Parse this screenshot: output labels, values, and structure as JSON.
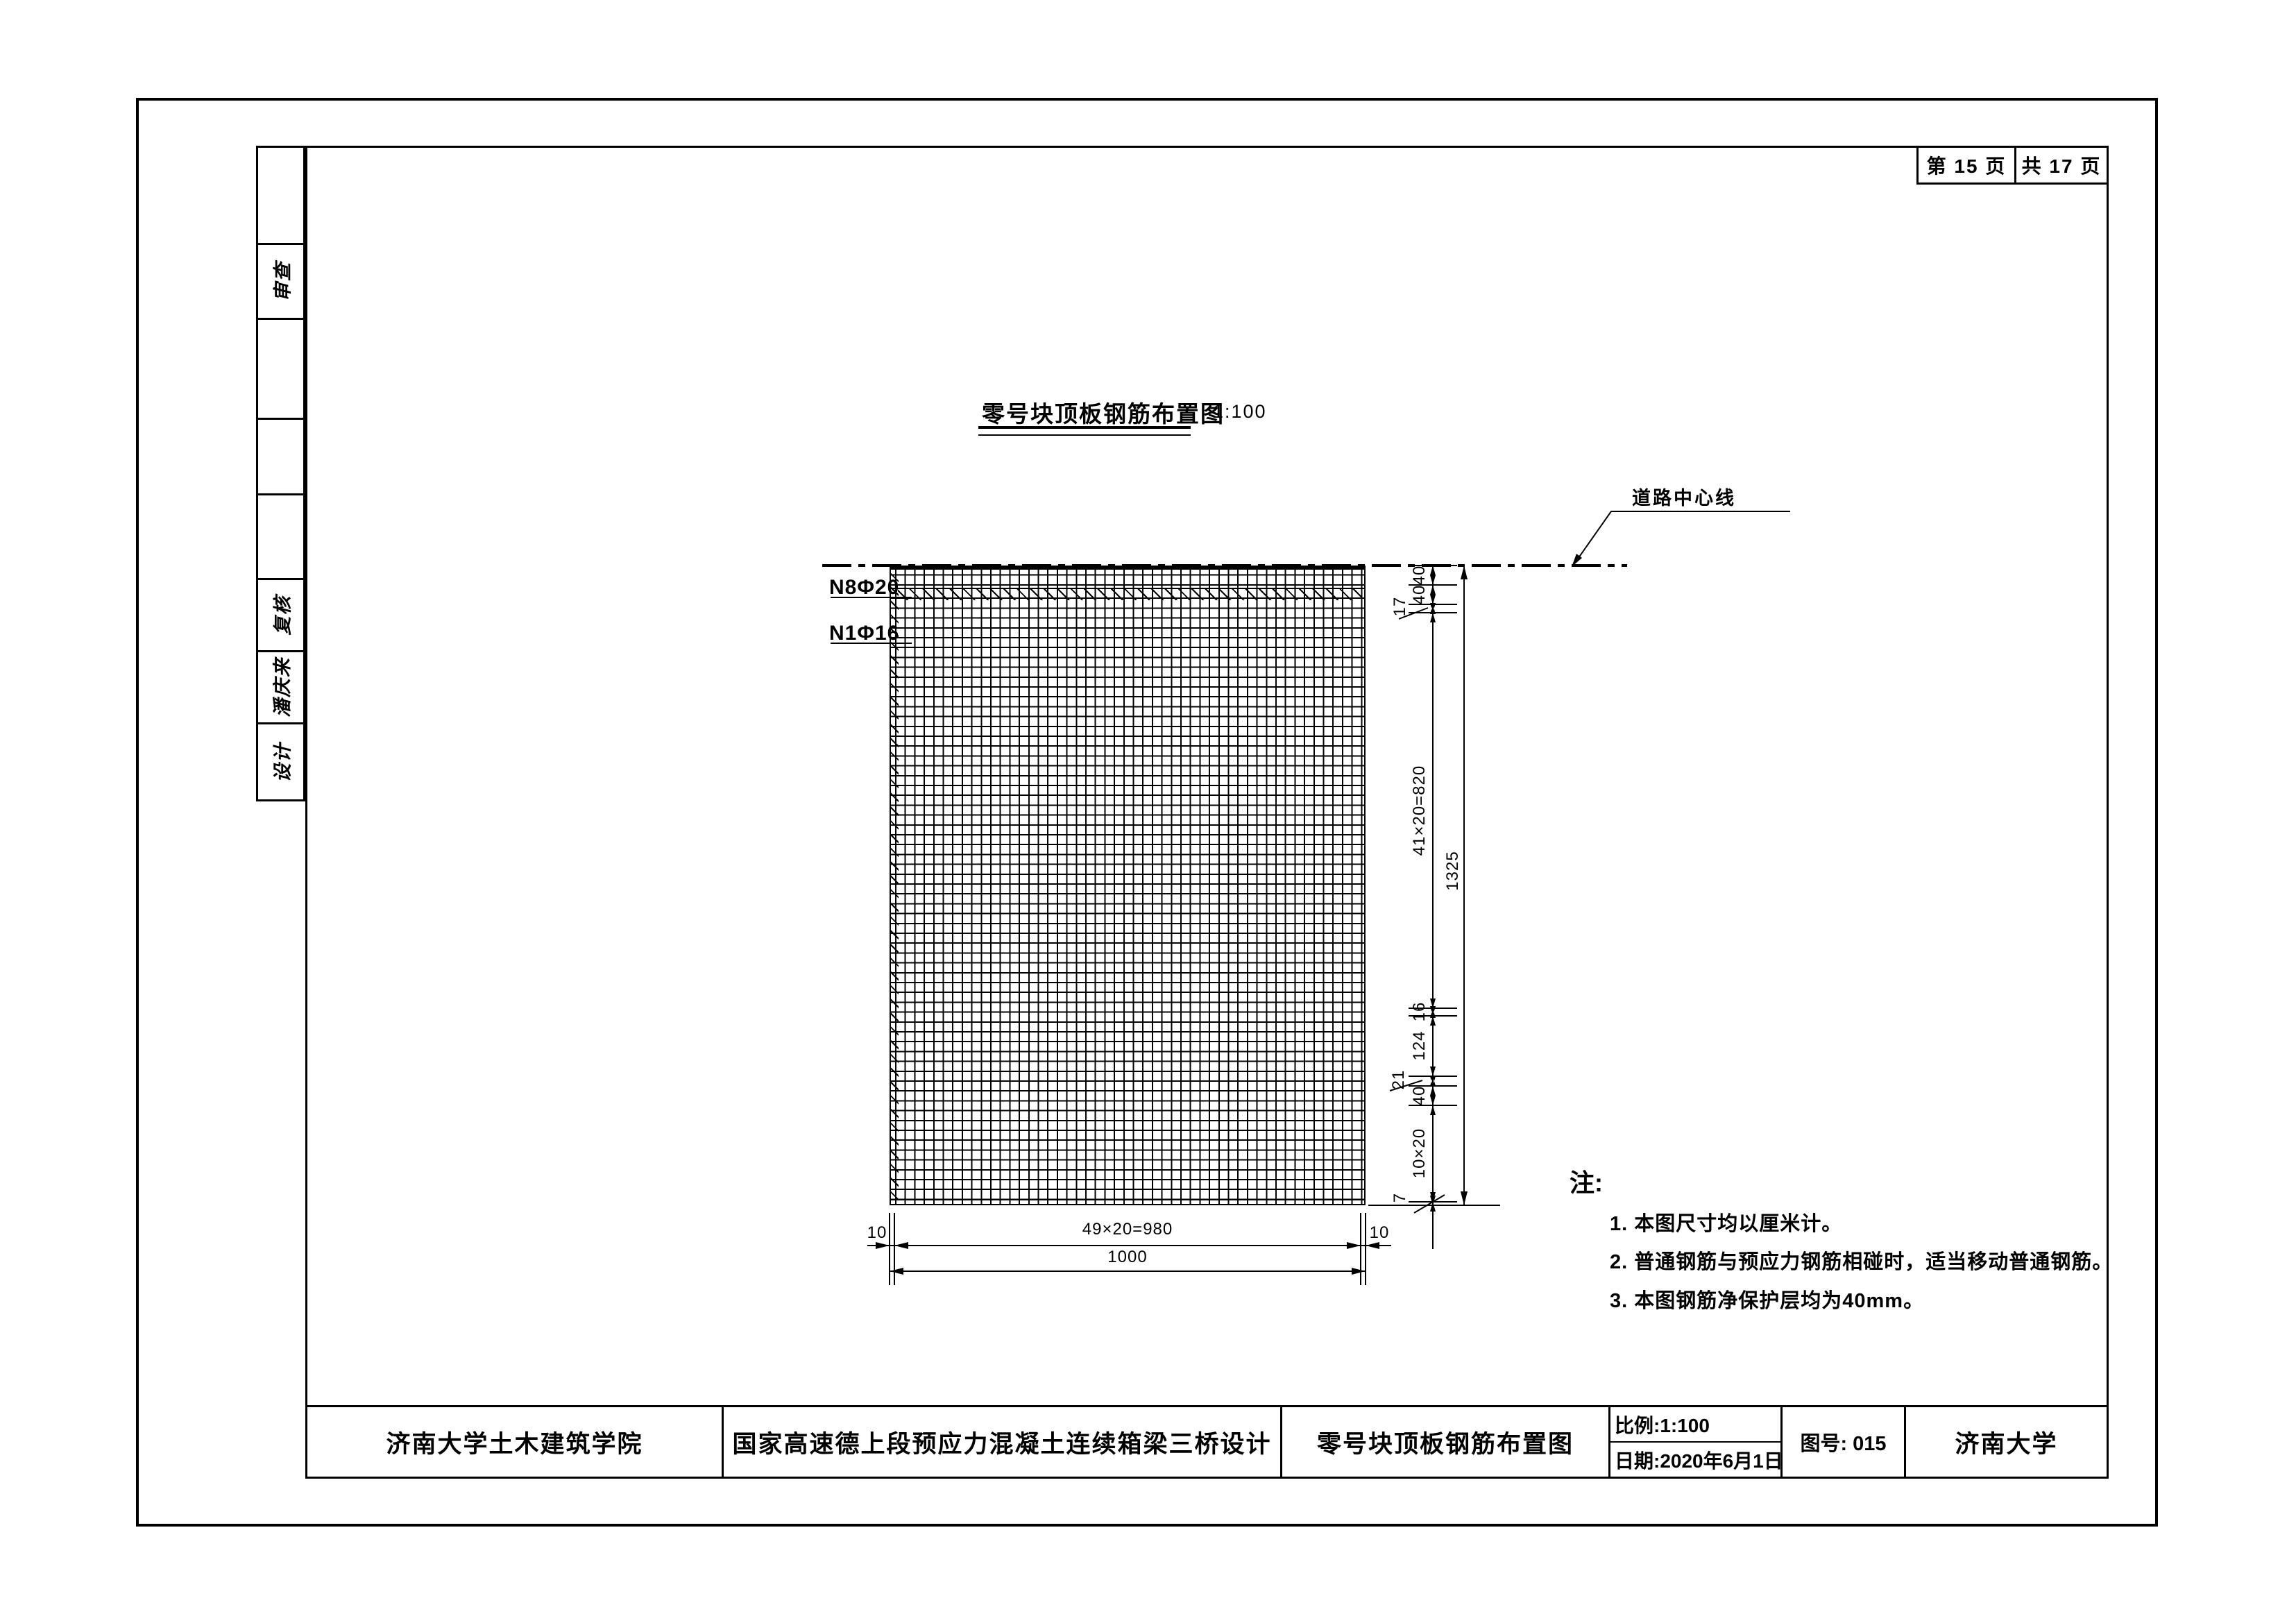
{
  "colors": {
    "ink": "#000000",
    "paper": "#ffffff"
  },
  "page_header": {
    "sheet_number": "第 15 页",
    "sheet_total": "共 17 页"
  },
  "sidebar": {
    "cells": [
      "",
      "审查",
      "",
      "",
      "",
      "复核",
      "潘庆来",
      "设计"
    ]
  },
  "drawing": {
    "title": "零号块顶板钢筋布置图",
    "scale": "1:100",
    "centerline_label": "道路中心线",
    "rebar_label_top": "N8Φ20",
    "rebar_label_bottom": "N1Φ16",
    "dims": {
      "right_chain": [
        "40",
        "40",
        "17",
        "41×20=820",
        "16",
        "124",
        "21",
        "40",
        "10×20",
        "7"
      ],
      "right_total": "1325",
      "bottom_chain": [
        "10",
        "49×20=980",
        "10"
      ],
      "bottom_total": "1000"
    }
  },
  "notes": {
    "heading": "注:",
    "items": [
      "1. 本图尺寸均以厘米计。",
      "2. 普通钢筋与预应力钢筋相碰时，适当移动普通钢筋。",
      "3. 本图钢筋净保护层均为40mm。"
    ]
  },
  "title_block": {
    "college": "济南大学土木建筑学院",
    "project": "国家高速德上段预应力混凝土连续箱梁三桥设计",
    "drawing_name": "零号块顶板钢筋布置图",
    "scale": "比例:1:100",
    "date": "日期:2020年6月1日",
    "number": "图号: 015",
    "university": "济南大学"
  }
}
